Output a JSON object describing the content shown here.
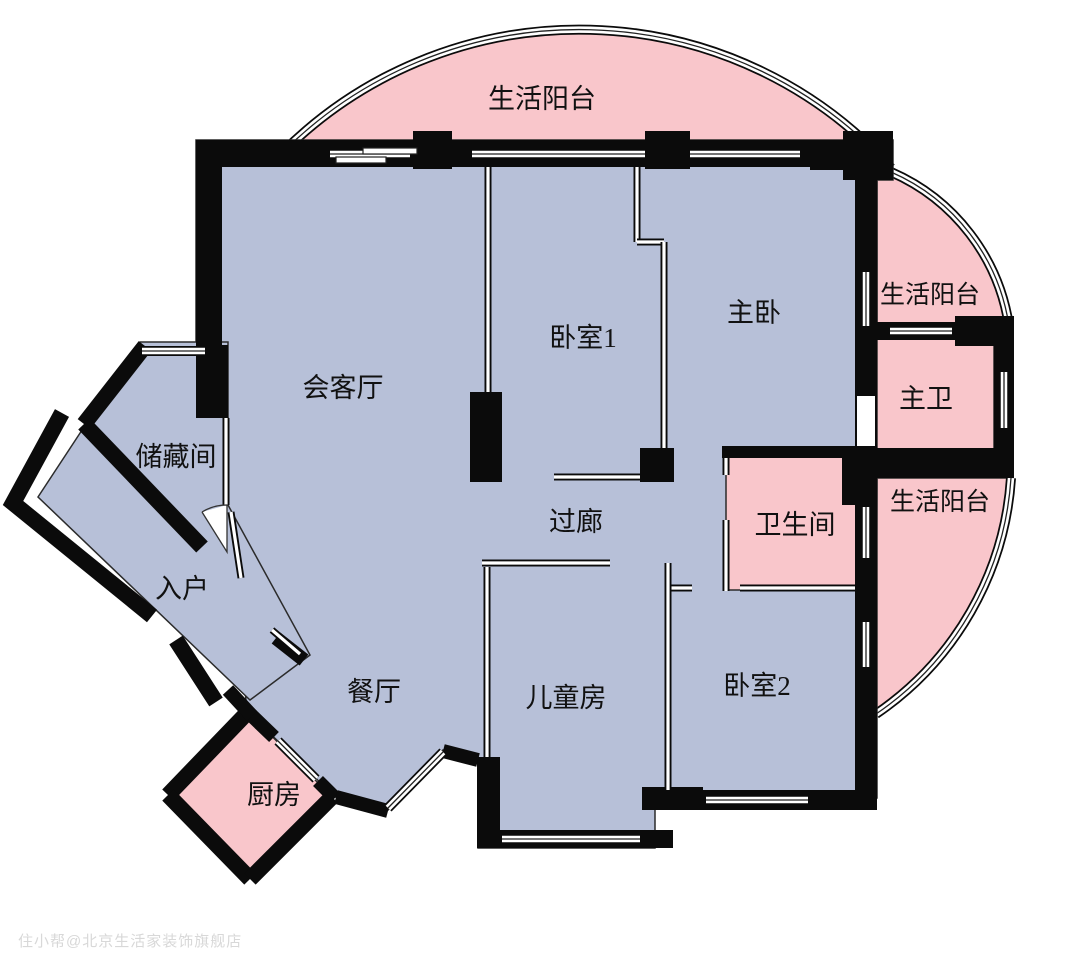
{
  "rooms": {
    "balcony_top": {
      "label": "生活阳台"
    },
    "living_room": {
      "label": "会客厅"
    },
    "bedroom1": {
      "label": "卧室1"
    },
    "master_bedroom": {
      "label": "主卧"
    },
    "balcony_right_upper": {
      "label": "生活阳台"
    },
    "master_bathroom": {
      "label": "主卫"
    },
    "balcony_right_lower": {
      "label": "生活阳台"
    },
    "storage_room": {
      "label": "储藏间"
    },
    "corridor": {
      "label": "过廊"
    },
    "bathroom": {
      "label": "卫生间"
    },
    "entry": {
      "label": "入户"
    },
    "dining_room": {
      "label": "餐厅"
    },
    "kids_room": {
      "label": "儿童房"
    },
    "bedroom2": {
      "label": "卧室2"
    },
    "kitchen": {
      "label": "厨房"
    }
  },
  "watermark": {
    "text": "住小帮@北京生活家装饰旗舰店"
  },
  "colors": {
    "room_fill": "#b7c0d8",
    "balcony_fill": "#f9c6cb",
    "wall": "#0b0b0b",
    "line": "#222222",
    "background": "#ffffff",
    "watermark_color": "#d8d8d8",
    "label_color": "#111111"
  }
}
